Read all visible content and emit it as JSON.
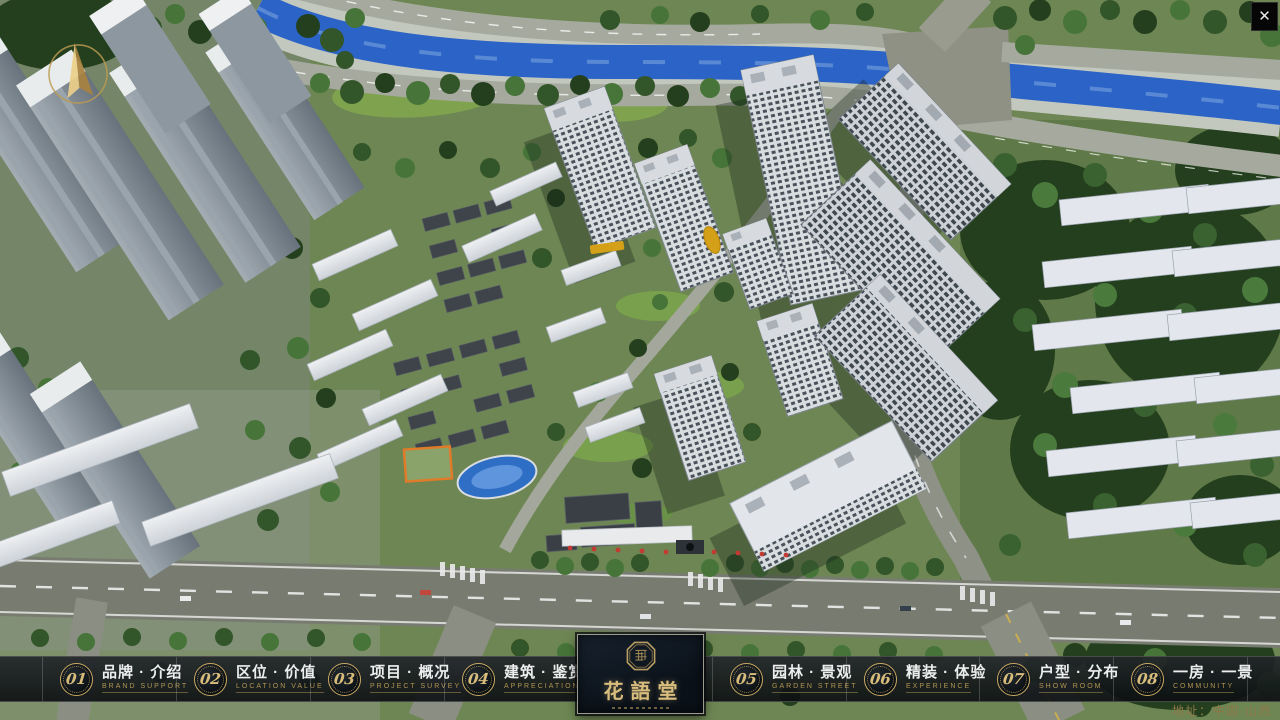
{
  "ui": {
    "close_glyph": "✕"
  },
  "nav": {
    "items": [
      {
        "num": "01",
        "label": "品牌 · 介绍",
        "sub": "BRAND SUPPORT"
      },
      {
        "num": "02",
        "label": "区位 · 价值",
        "sub": "LOCATION VALUE"
      },
      {
        "num": "03",
        "label": "项目 · 概况",
        "sub": "PROJECT SURVEY"
      },
      {
        "num": "04",
        "label": "建筑 · 鉴赏",
        "sub": "APPRECIATION"
      },
      {
        "num": "05",
        "label": "园林 · 景观",
        "sub": "GARDEN STREET"
      },
      {
        "num": "06",
        "label": "精装 · 体验",
        "sub": "EXPERIENCE"
      },
      {
        "num": "07",
        "label": "户型 · 分布",
        "sub": "SHOW ROOM"
      },
      {
        "num": "08",
        "label": "一房 · 一景",
        "sub": "COMMUNITY"
      }
    ]
  },
  "logo": {
    "name": "花語堂"
  },
  "footer": {
    "address": "地址：中国·山西"
  },
  "colors": {
    "accent_gold": "#c9a962",
    "logo_text": "#d9bd7d",
    "bar_bg": "#14181c",
    "river_blue": "#2b63c6",
    "grass_green": "#6d8653",
    "tree_green": "#2c4a22"
  }
}
